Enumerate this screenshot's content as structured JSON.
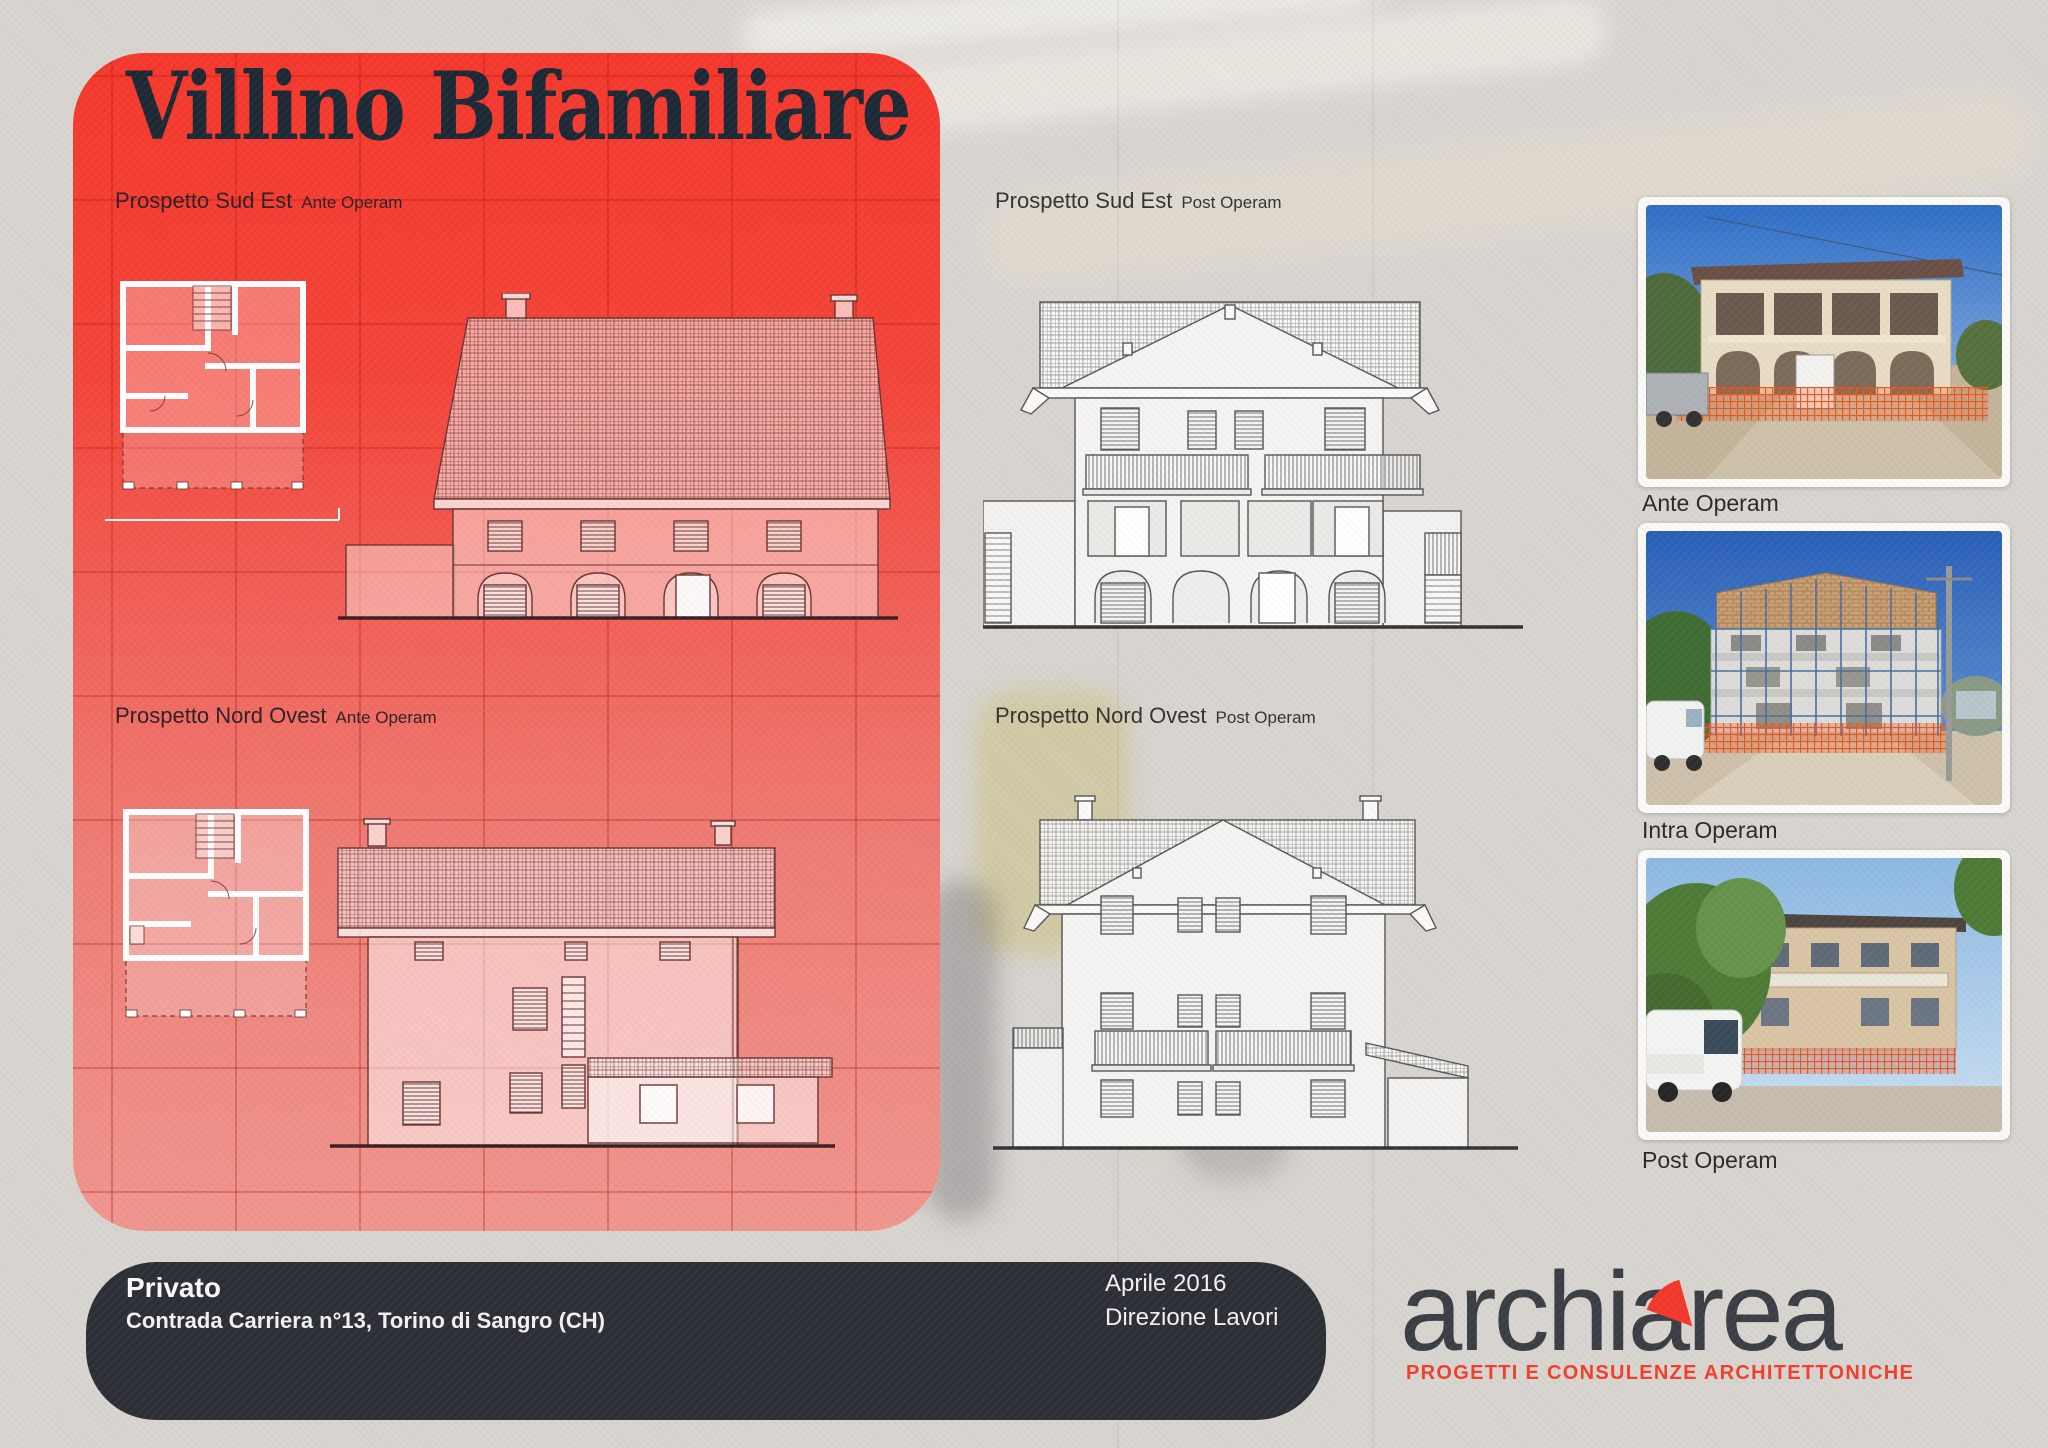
{
  "title": "Villino Bifamiliare",
  "colors": {
    "panel_red_top": "#f5382d",
    "panel_red_bottom": "#f0968e",
    "footer_bar": "#2c3036",
    "accent_red": "#f23e2c",
    "logo_text": "#3b3e44",
    "background": "#d8d5d1",
    "title_text": "#1d2935"
  },
  "sections": [
    {
      "label": "Prospetto Sud Est",
      "sublabel": "Ante Operam"
    },
    {
      "label": "Prospetto Sud Est",
      "sublabel": "Post Operam"
    },
    {
      "label": "Prospetto Nord Ovest",
      "sublabel": "Ante Operam"
    },
    {
      "label": "Prospetto Nord Ovest",
      "sublabel": "Post Operam"
    }
  ],
  "photos": [
    {
      "caption": "Ante Operam"
    },
    {
      "caption": "Intra Operam"
    },
    {
      "caption": "Post Operam"
    }
  ],
  "footer": {
    "client": "Privato",
    "address": "Contrada Carriera n°13, Torino di Sangro (CH)",
    "date": "Aprile 2016",
    "phase": "Direzione Lavori"
  },
  "logo": {
    "name": "archiarea",
    "tagline": "PROGETTI E CONSULENZE ARCHITETTONICHE"
  }
}
